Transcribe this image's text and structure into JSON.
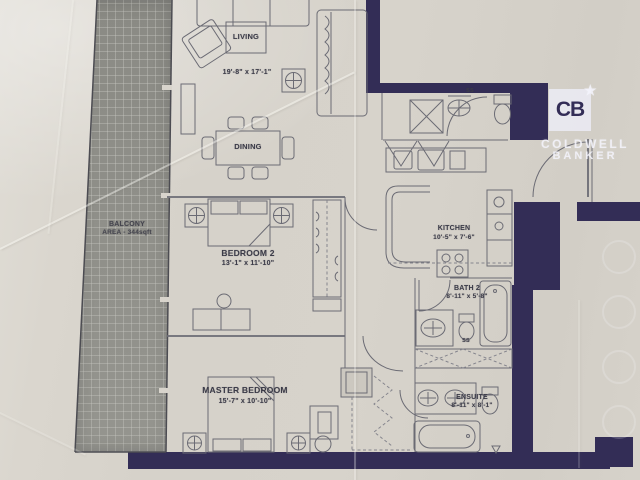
{
  "document": {
    "kind": "condo floor plan (photographed paper)"
  },
  "branding": {
    "monogram": "CB",
    "star": "★",
    "name_line1": "COLDWELL",
    "name_line2": "BANKER"
  },
  "balcony": {
    "name": "BALCONY",
    "area": "AREA - 344sqft"
  },
  "rooms": {
    "living": {
      "name": "LIVING",
      "dims": "19'-8\" x 17'-1\""
    },
    "dining": {
      "name": "DINING"
    },
    "kitchen": {
      "name": "KITCHEN",
      "dims": "10'-5\" x 7'-6\""
    },
    "bedroom2": {
      "name": "BEDROOM 2",
      "dims": "13'-1\" x 11'-10\""
    },
    "master": {
      "name": "MASTER BEDROOM",
      "dims": "15'-7\" x 10'-10\""
    },
    "bath2": {
      "name": "BATH 2",
      "dims": "8'-11\" x 5'-8\""
    },
    "ensuite": {
      "name": "ENSUITE",
      "dims": "8'-11\" x 8'-1\""
    }
  },
  "codes": {
    "ss": "SS"
  },
  "colors": {
    "wall": "#332d56",
    "line": "#6b6b74",
    "paper": "#d7d3cb",
    "balcony_fill": "#8f8f89",
    "balcony_grid": "#cacac4",
    "watermark": "#eeeef8"
  }
}
